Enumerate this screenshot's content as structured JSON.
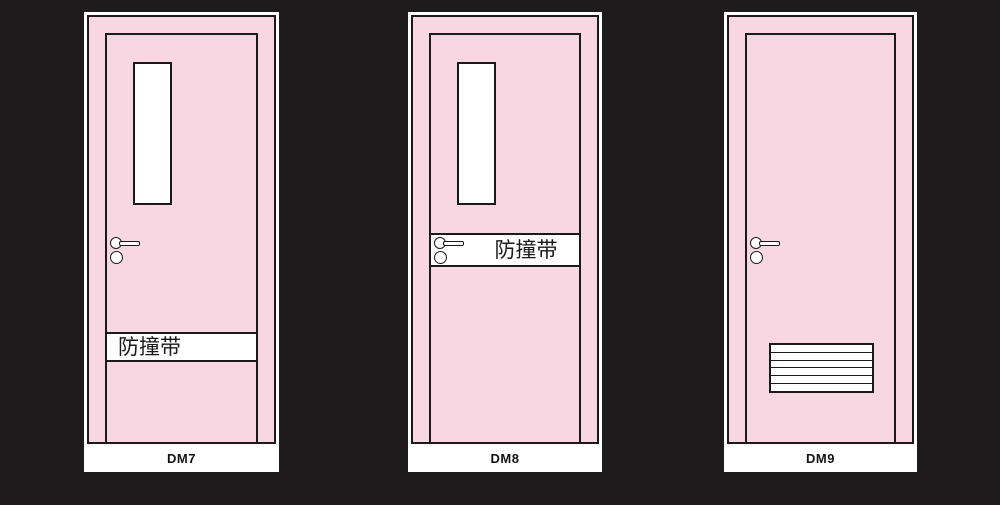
{
  "page": {
    "background_color": "#1d1b1c"
  },
  "colors": {
    "door_pink": "#f8d7e3",
    "outline_black": "#1a1a1a",
    "panel_white": "#ffffff"
  },
  "doors": [
    {
      "label": "DM7",
      "features": {
        "window": true,
        "handle": true,
        "band_text": "防撞带"
      }
    },
    {
      "label": "DM8",
      "features": {
        "window": true,
        "handle": true,
        "band_text": "防撞带"
      }
    },
    {
      "label": "DM9",
      "features": {
        "handle": true,
        "louver_slats": 6
      }
    }
  ]
}
